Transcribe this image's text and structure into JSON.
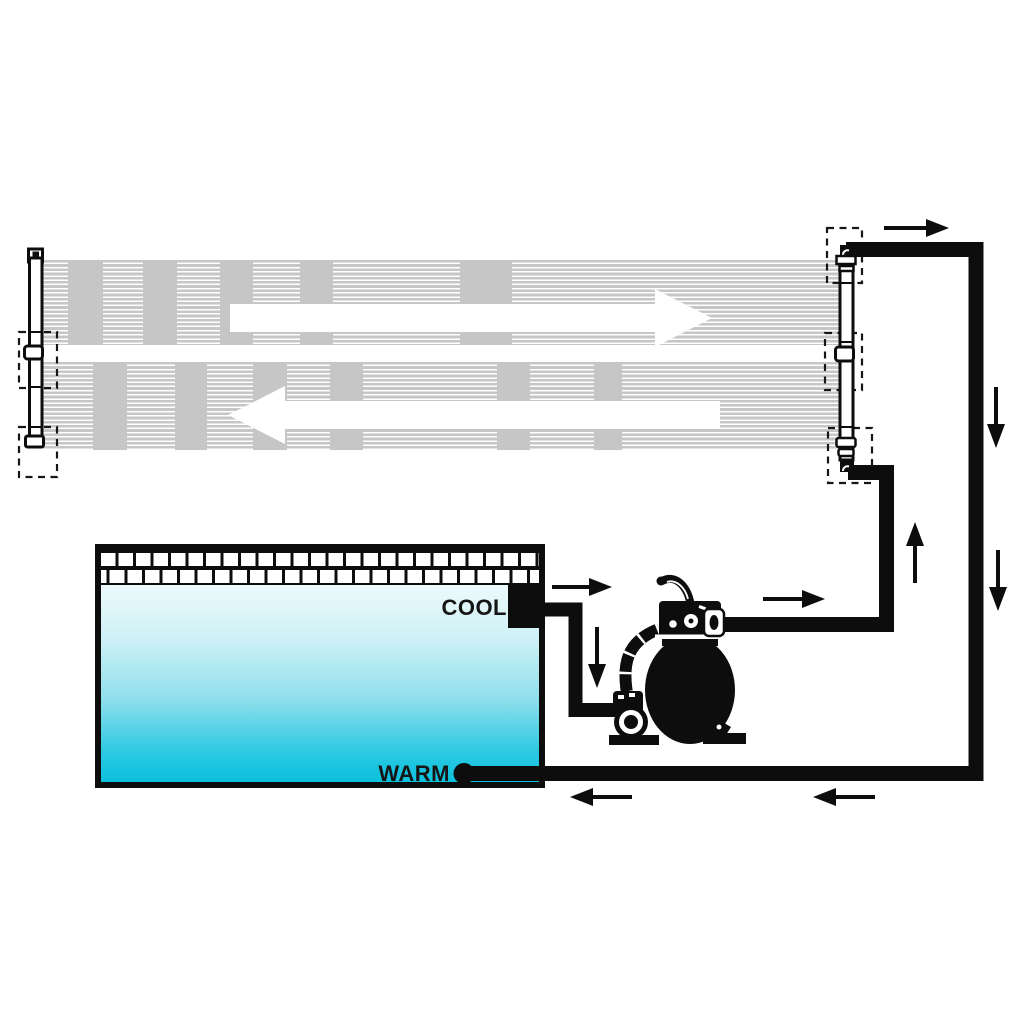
{
  "diagram": {
    "type": "solar-pool-heating-system-schematic",
    "pool": {
      "cool_label": "COOL",
      "warm_label": "WARM"
    },
    "colors": {
      "background": "#ffffff",
      "line_black": "#0d0d0d",
      "panel_stripe_gray": "#c6c6c6",
      "water_top": "#edfafc",
      "water_bottom": "#0cc0dd"
    },
    "icons": [
      "solar-collector-panel-top",
      "solar-collector-panel-bottom",
      "flow-arrow-right-icon",
      "flow-arrow-left-icon",
      "left-manifold",
      "right-manifold",
      "hot-water-pipe",
      "cool-water-pipe",
      "pump-to-collector-pipe",
      "skimmer-box",
      "sand-filter-pump",
      "flow-direction-arrow-icon"
    ]
  }
}
